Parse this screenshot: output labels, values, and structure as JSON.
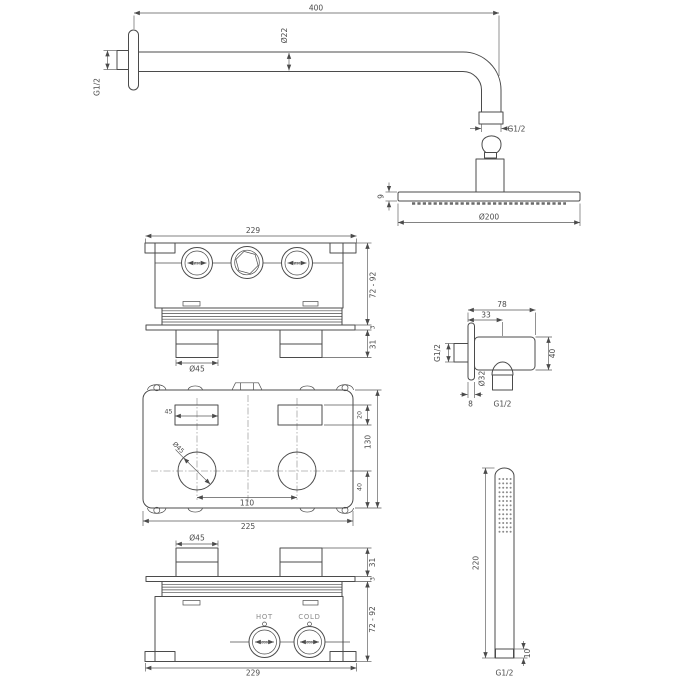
{
  "page": {
    "background": "#ffffff"
  },
  "style": {
    "line_color": "#4b4b4b",
    "dim_color": "#585858",
    "muted_color": "#8a8a8a",
    "knurl_fill_dark": "#d6d6d6",
    "knurl_fill_light": "#e9e9e9"
  },
  "overhead_shower": {
    "arm_length": "400",
    "arm_diameter": "Ø22",
    "wall_connection_thread": "G1/2",
    "head_connection_thread": "G1/2",
    "head_thickness": "9",
    "head_diameter": "Ø200"
  },
  "valve_front_view": {
    "overall_width": "229",
    "mounting_depth_range": "72 - 92",
    "plate_thickness": "3",
    "handle_height": "31",
    "handle_diameter": "Ø45",
    "port_bore": "Ø30"
  },
  "wall_outlet": {
    "overall_width": "78",
    "outlet_offset": "33",
    "body_height": "40",
    "outlet_diameter": "Ø32",
    "flange_thickness": "8",
    "wall_thread": "G1/2",
    "hose_thread": "G1/2"
  },
  "valve_plan_view": {
    "overall_width": "225",
    "overall_depth": "130",
    "slot_width": "45",
    "slot_depth": "20",
    "handle_spacing": "110",
    "handle_axis_offset": "40",
    "handle_diameter": "Ø45"
  },
  "valve_bottom_view": {
    "overall_width": "229",
    "mounting_depth_range": "72 - 92",
    "plate_thickness": "3",
    "handle_height": "31",
    "handle_diameter": "Ø45",
    "hot_label": "HOT",
    "cold_label": "COLD",
    "port_bore": "Ø30"
  },
  "hand_shower": {
    "length": "220",
    "connector_height": "10",
    "thread": "G1/2"
  }
}
